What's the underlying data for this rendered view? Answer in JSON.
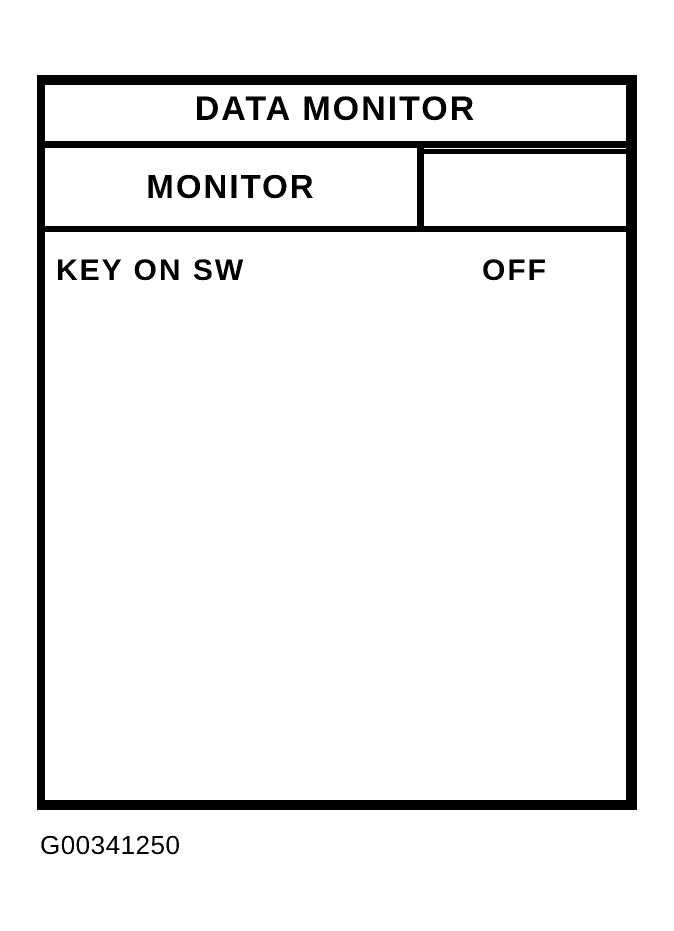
{
  "figure": {
    "screen_title": "DATA MONITOR",
    "header": {
      "monitor_label": "MONITOR",
      "status_label": ""
    },
    "rows": [
      {
        "name": "KEY ON SW",
        "value": "OFF"
      }
    ],
    "figure_id": "G00341250",
    "colors": {
      "ink": "#000000",
      "paper": "#ffffff"
    }
  }
}
